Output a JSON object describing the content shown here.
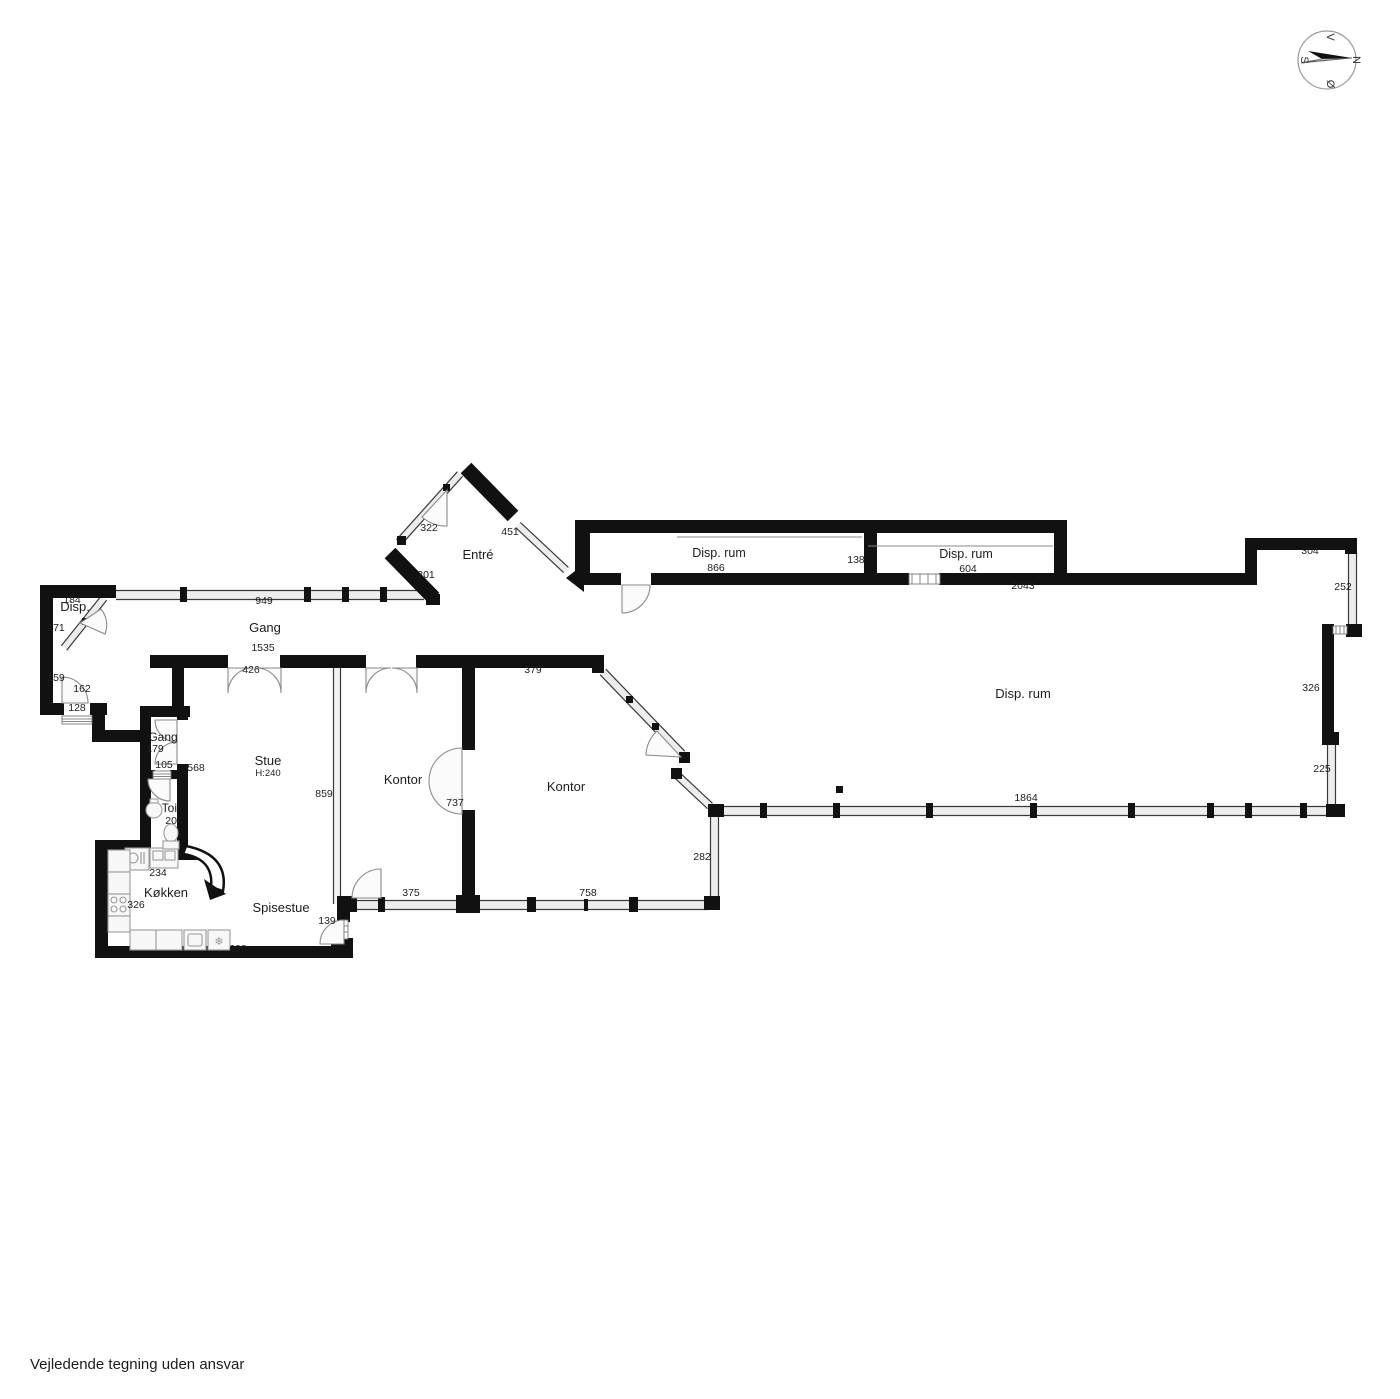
{
  "page": {
    "disclaimer": "Vejledende tegning uden ansvar"
  },
  "colors": {
    "wall": "#111111",
    "glass_fill": "#ededed",
    "glass_edge": "#3a3a3a",
    "door_arc": "#8a8a8a",
    "label": "#1c1c1c",
    "dimension": "#1c1c1c"
  },
  "compass": {
    "points": {
      "top": "V",
      "right": "N",
      "left": "S",
      "bottom": "Ø"
    }
  },
  "rooms": [
    {
      "id": "disp-left",
      "label": "Disp.",
      "x": 75,
      "y": 611,
      "size": 13
    },
    {
      "id": "gang-corridor",
      "label": "Gang",
      "x": 265,
      "y": 632,
      "size": 13
    },
    {
      "id": "entre",
      "label": "Entré",
      "x": 478,
      "y": 559,
      "size": 13
    },
    {
      "id": "disp-rum-1",
      "label": "Disp. rum",
      "x": 719,
      "y": 557,
      "size": 12.5
    },
    {
      "id": "disp-rum-2",
      "label": "Disp. rum",
      "x": 966,
      "y": 558,
      "size": 12.5
    },
    {
      "id": "disp-rum-big",
      "label": "Disp. rum",
      "x": 1023,
      "y": 698,
      "size": 13
    },
    {
      "id": "stue",
      "label": "Stue",
      "sub": "H:240",
      "x": 268,
      "y": 765,
      "size": 13
    },
    {
      "id": "kontor-1",
      "label": "Kontor",
      "x": 403,
      "y": 784,
      "size": 13
    },
    {
      "id": "kontor-2",
      "label": "Kontor",
      "x": 566,
      "y": 791,
      "size": 13
    },
    {
      "id": "gang-small",
      "label": "Gang",
      "x": 163,
      "y": 741,
      "size": 12
    },
    {
      "id": "toi",
      "label": "Toi.",
      "x": 171,
      "y": 812,
      "size": 12
    },
    {
      "id": "kokken",
      "label": "Køkken",
      "x": 166,
      "y": 897,
      "size": 13
    },
    {
      "id": "spisestue",
      "label": "Spisestue",
      "x": 281,
      "y": 912,
      "size": 13
    }
  ],
  "dimensions": [
    {
      "value": "184",
      "x": 72,
      "y": 603
    },
    {
      "value": "171",
      "x": 56,
      "y": 631
    },
    {
      "value": "159",
      "x": 56,
      "y": 681
    },
    {
      "value": "162",
      "x": 82,
      "y": 692
    },
    {
      "value": "128",
      "x": 77,
      "y": 711
    },
    {
      "value": "949",
      "x": 264,
      "y": 604
    },
    {
      "value": "1535",
      "x": 263,
      "y": 651
    },
    {
      "value": "426",
      "x": 251,
      "y": 673
    },
    {
      "value": "322",
      "x": 429,
      "y": 531
    },
    {
      "value": "451",
      "x": 510,
      "y": 535
    },
    {
      "value": "201",
      "x": 426,
      "y": 578
    },
    {
      "value": "866",
      "x": 716,
      "y": 571
    },
    {
      "value": "138",
      "x": 856,
      "y": 563
    },
    {
      "value": "604",
      "x": 968,
      "y": 572
    },
    {
      "value": "2043",
      "x": 1023,
      "y": 589
    },
    {
      "value": "304",
      "x": 1310,
      "y": 554
    },
    {
      "value": "252",
      "x": 1343,
      "y": 590
    },
    {
      "value": "326",
      "x": 1311,
      "y": 691
    },
    {
      "value": "225",
      "x": 1322,
      "y": 772
    },
    {
      "value": "1864",
      "x": 1026,
      "y": 801
    },
    {
      "value": "379",
      "x": 533,
      "y": 673
    },
    {
      "value": "859",
      "x": 324,
      "y": 797
    },
    {
      "value": "737",
      "x": 455,
      "y": 806
    },
    {
      "value": "568",
      "x": 196,
      "y": 771
    },
    {
      "value": "179",
      "x": 155,
      "y": 752
    },
    {
      "value": "105",
      "x": 164,
      "y": 768
    },
    {
      "value": "204",
      "x": 174,
      "y": 824
    },
    {
      "value": "234",
      "x": 158,
      "y": 876
    },
    {
      "value": "326",
      "x": 136,
      "y": 908
    },
    {
      "value": "698",
      "x": 238,
      "y": 952
    },
    {
      "value": "375",
      "x": 411,
      "y": 896
    },
    {
      "value": "758",
      "x": 588,
      "y": 896
    },
    {
      "value": "282",
      "x": 702,
      "y": 860
    },
    {
      "value": "139",
      "x": 327,
      "y": 924
    }
  ]
}
